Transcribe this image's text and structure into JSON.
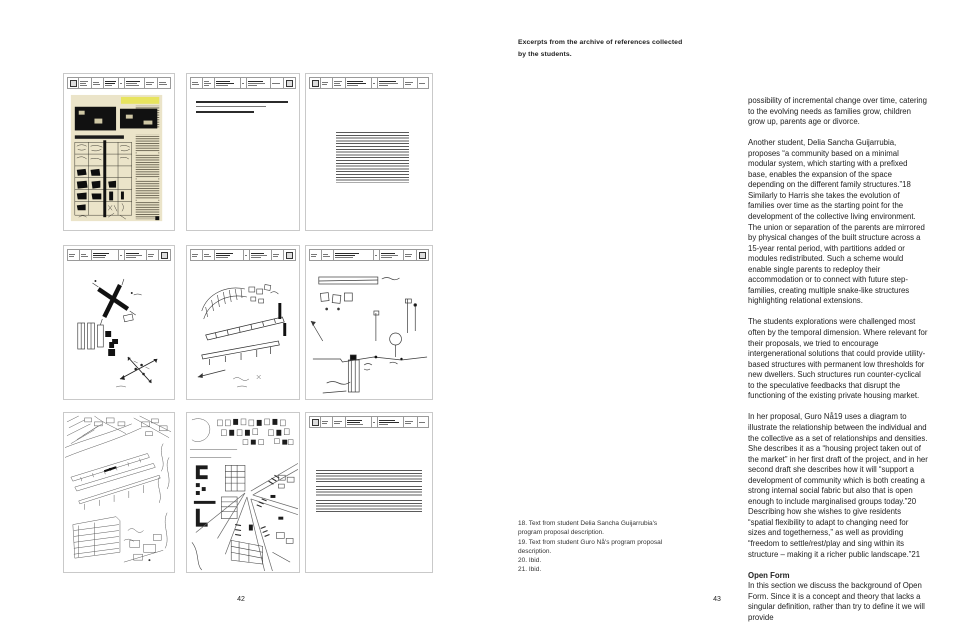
{
  "caption": {
    "text": "Excerpts from the archive of references collected by the students."
  },
  "left_page": {
    "page_number": "42",
    "grid": {
      "panels": [
        {
          "id": "card-1",
          "kind": "scanned magazine page with photos and plan matrix"
        },
        {
          "id": "card-2",
          "kind": "typed reference card, short entry"
        },
        {
          "id": "card-3",
          "kind": "typed reference card, long description"
        },
        {
          "id": "card-4",
          "kind": "plan sketch with crossing axes"
        },
        {
          "id": "card-5",
          "kind": "perspective structure sketch"
        },
        {
          "id": "card-6",
          "kind": "section sketch with posts"
        },
        {
          "id": "card-7",
          "kind": "aerial pencil drawing of linear buildings"
        },
        {
          "id": "card-8",
          "kind": "aerial urban perspective drawing"
        },
        {
          "id": "card-9",
          "kind": "typed reference card, paragraphs"
        }
      ]
    }
  },
  "right_page": {
    "page_number": "43",
    "paragraphs": [
      "possibility of incremental change over time, catering to the evolving needs as families grow, children grow up, parents age or divorce.",
      "Another student, Delia Sancha Guijarrubia, proposes “a community based on a minimal modular system, which starting with a prefixed base, enables the expansion of the space depending on the different family structures.”18 Similarly to Harris she takes the evolution of families over time as the starting point for the development of the collective living environment. The union or separation of the parents are mirrored by physical changes of the built structure across a 15-year rental period, with partitions added or modules redistributed. Such a scheme would enable single parents to redeploy their accommodation or to connect with future step-families, creating multiple snake-like structures highlighting relational extensions.",
      "The students explorations were challenged most often by the temporal dimension. Where relevant for their proposals, we tried to encourage intergenerational solutions that could provide utility-based structures with permanent low thresholds for new dwellers. Such structures run counter-cyclical to the speculative feedbacks that disrupt the functioning of the existing private housing market.",
      "In her proposal, Guro Nå19 uses a diagram to illustrate the relationship between the individual and the collective as a set of relationships and densities. She describes it as a “housing project taken out of the market” in her first draft of the project, and in her second draft she describes how it will “support a development of community which is both creating a strong internal social fabric but also that is open enough to include marginalised groups today.”20 Describing how she wishes to give residents “spatial flexibility to adapt to changing need for sizes and togetherness,” as well as providing “freedom to settle/rest/play and sing within its structure – making it a richer public landscape.”21"
    ],
    "heading": "Open Form",
    "closing_paragraph": "In this section we discuss the background of Open Form. Since it is a concept and theory that lacks a singular definition, rather than try to define it we will provide",
    "footnotes": [
      "18. Text from student Delia Sancha Guijarrubia's program proposal description.",
      "19. Text from student Guro Nå's program proposal description.",
      "20. Ibid.",
      "21. Ibid."
    ]
  }
}
